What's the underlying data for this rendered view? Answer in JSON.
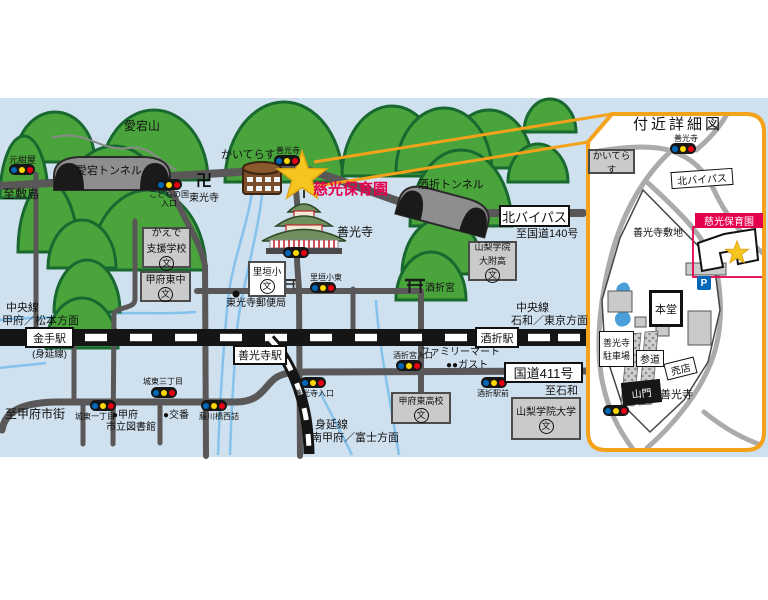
{
  "colors": {
    "map_bg": "#cfe0ee",
    "tree_green": "#4aa43c",
    "tree_outline": "#18682f",
    "road_gray": "#595757",
    "inset_road_gray": "#ababab",
    "rail_black": "#151515",
    "river_blue": "#85c2ec",
    "accent_red": "#e5004f",
    "callout_orange": "#f5a21b",
    "signal_blue": "#0068b7",
    "signal_yellow": "#ffd800",
    "signal_red": "#e60012",
    "star_yellow": "#f6c51f",
    "gray_box": "#c9caca",
    "building_brown": "#7b4d28"
  },
  "main_map": {
    "mountain_label": "愛宕山",
    "tunnels": {
      "atago": "愛宕トンネル",
      "sakaori": "酒折トンネル"
    },
    "edge_labels": {
      "to_shikishima": "至敷島",
      "to_kofu_city": "至甲府市街",
      "to_isawa": "至石和",
      "to_route140": "至国道140号"
    },
    "route_boxes": {
      "kita_bypass": "北バイパス",
      "route411": "国道411号"
    },
    "rail": {
      "chuo_left_1": "中央線",
      "chuo_left_2": "甲府／松本方面",
      "chuo_right_1": "中央線",
      "chuo_right_2": "石和／東京方面",
      "minobu_1": "身延線",
      "minobu_2": "南甲府／富士方面",
      "kanade": "金手駅",
      "kanade_note": "(身延線)",
      "zenkoji_sta": "善光寺駅",
      "sakaori_sta": "酒折駅"
    },
    "signals": {
      "motokonya": "元紺屋",
      "kodomo_1": "こどもの国",
      "kodomo_2": "入口",
      "zenkoji": "善光寺",
      "satogaki_higashi": "里垣小東",
      "sakaorigu_iriguchi": "酒折宮入口",
      "zenkoji_iriguchi": "善光寺入口",
      "joto3": "城東三丁目",
      "joto1": "城東一丁目",
      "fujikawabashi": "藤川橋西詰",
      "sakaori_ekimae": "酒折駅前"
    },
    "landmarks": {
      "kaiterasu": "かいてらす",
      "manji": "卍",
      "tokoji": "東光寺",
      "nursery": "慈光保育園",
      "zenkoji_temple": "善光寺",
      "post_office": "東光寺郵便局",
      "sakaorigu": "酒折宮",
      "familymart": "ファミリーマート",
      "gusto": "●●ガスト",
      "library_1": "●甲府",
      "library_2": "市立図書館",
      "koban": "●交番"
    },
    "schools": {
      "kaede_1": "かえで",
      "kaede_2": "支援学校",
      "kofu_higashi_jhs": "甲府東中",
      "satogaki_es": "里垣小",
      "yg_hs_1": "山梨学院",
      "yg_hs_2": "大附高",
      "kofu_higashi_hs": "甲府東高校",
      "yg_univ": "山梨学院大学",
      "school_mark": "文"
    }
  },
  "inset": {
    "title": "付近詳細図",
    "signal_zenkoji": "善光寺",
    "kaiterasu": "かいてらす",
    "kita_bypass": "北バイパス",
    "grounds": "善光寺敷地",
    "nursery": "慈光保育園",
    "hondo": "本堂",
    "parking_p": "P",
    "parking_1": "善光寺",
    "parking_2": "駐車場",
    "sando": "参道",
    "baiten": "売店",
    "sanmon": "山門",
    "zenkoji": "善光寺"
  }
}
